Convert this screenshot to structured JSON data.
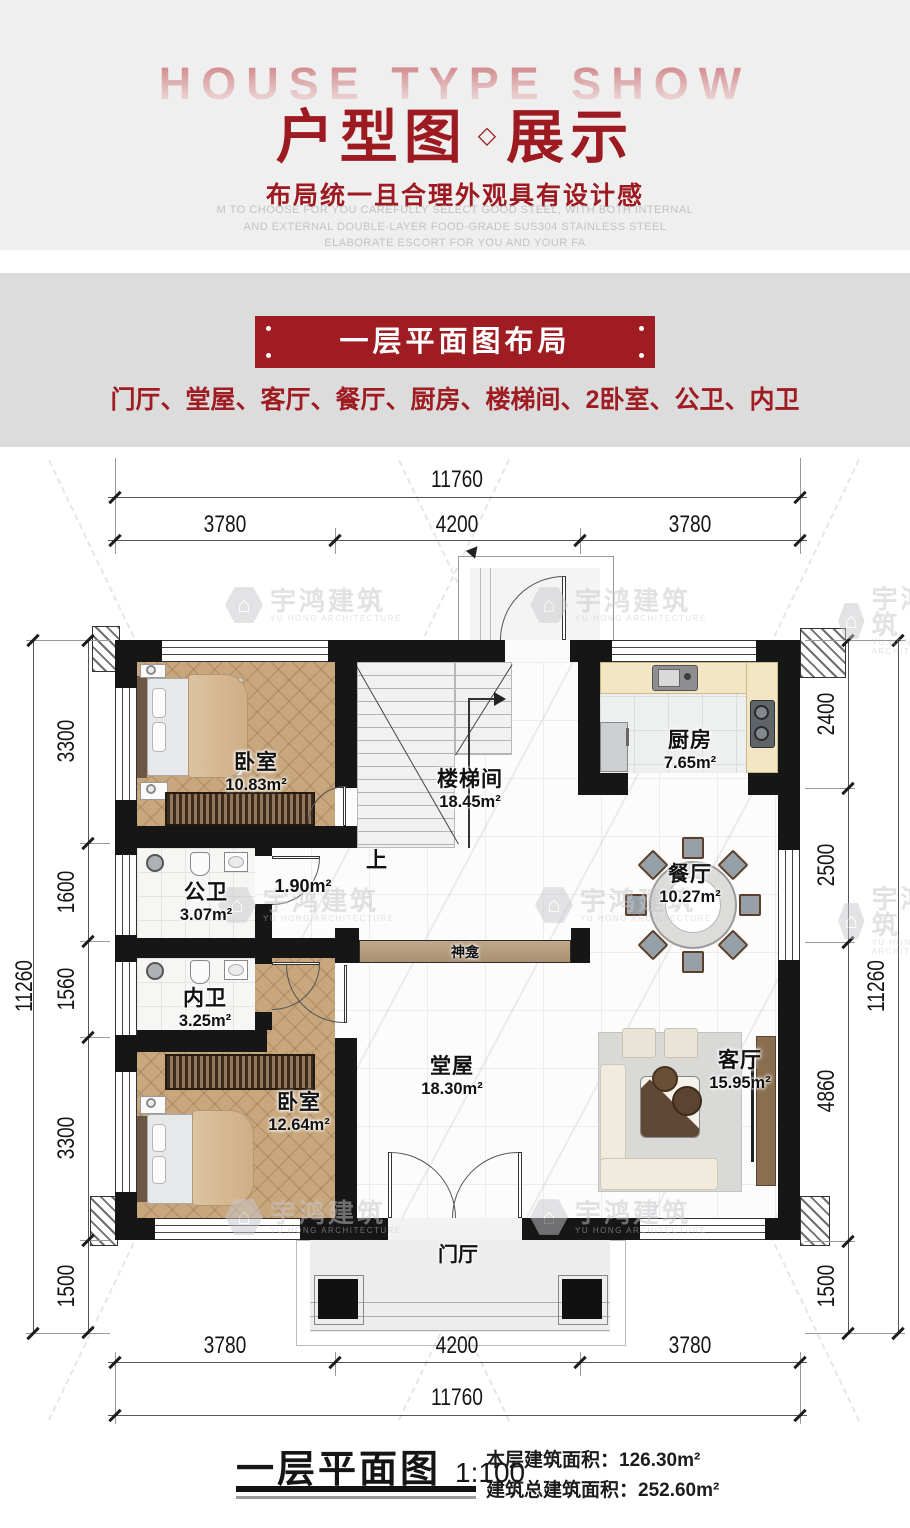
{
  "header": {
    "bg_text": "HOUSE TYPE SHOW",
    "title_left": "户型图",
    "title_diamond": "◇",
    "title_right": "展示",
    "subtitle": "布局统一且合理外观具有设计感",
    "english_lines": [
      "M TO CHOOSE FOR YOU CAREFULLY SELECT GOOD STEEL, WITH BOTH INTERNAL",
      "AND EXTERNAL DOUBLE-LAYER FOOD-GRADE SUS304 STAINLESS STEEL",
      "ELABORATE ESCORT FOR YOU AND YOUR FA"
    ]
  },
  "section": {
    "banner": "一层平面图布局",
    "room_list": "门厅、堂屋、客厅、餐厅、厨房、楼梯间、2卧室、公卫、内卫"
  },
  "plan": {
    "dimensions": {
      "top": {
        "total": "11760",
        "segments": [
          "3780",
          "4200",
          "3780"
        ]
      },
      "bottom": {
        "total": "11760",
        "segments": [
          "3780",
          "4200",
          "3780"
        ]
      },
      "left": {
        "total": "11260",
        "segments": [
          "3300",
          "1600",
          "1560",
          "3300",
          "1500"
        ]
      },
      "right": {
        "total": "11260",
        "segments": [
          "2400",
          "2500",
          "4860",
          "1500"
        ]
      }
    },
    "rooms": {
      "bedroom_top": {
        "name": "卧室",
        "area": "10.83m²"
      },
      "stairwell": {
        "name": "楼梯间",
        "area": "18.45m²"
      },
      "kitchen": {
        "name": "厨房",
        "area": "7.65m²"
      },
      "dining": {
        "name": "餐厅",
        "area": "10.27m²"
      },
      "public_bath": {
        "name": "公卫",
        "area": "3.07m²"
      },
      "hallway": {
        "area": "1.90m²"
      },
      "inner_bath": {
        "name": "内卫",
        "area": "3.25m²"
      },
      "bedroom_bottom": {
        "name": "卧室",
        "area": "12.64m²"
      },
      "main_hall": {
        "name": "堂屋",
        "area": "18.30m²"
      },
      "living": {
        "name": "客厅",
        "area": "15.95m²"
      },
      "entrance": {
        "name": "门厅"
      },
      "shrine": {
        "name": "神龛"
      },
      "stairs_up": "上"
    }
  },
  "watermark": {
    "cn": "宇鸿建筑",
    "en": "YU HONG ARCHITECTURE"
  },
  "footer": {
    "title": "一层平面图",
    "scale": "1:100",
    "floor_area_label": "本层建筑面积：",
    "floor_area_value": "126.30m²",
    "total_area_label": "建筑总建筑面积：",
    "total_area_value": "252.60m²"
  },
  "colors": {
    "accent_red": "#9e1c22",
    "title_red": "#9c1a20",
    "wall_black": "#161616",
    "wood_floor": "#c8a77d",
    "kitchen_counter": "#f2e6c4",
    "shrine_wood": "#b49a7e",
    "band_gray": "#dcdcdc",
    "header_gray": "#efeff0"
  }
}
